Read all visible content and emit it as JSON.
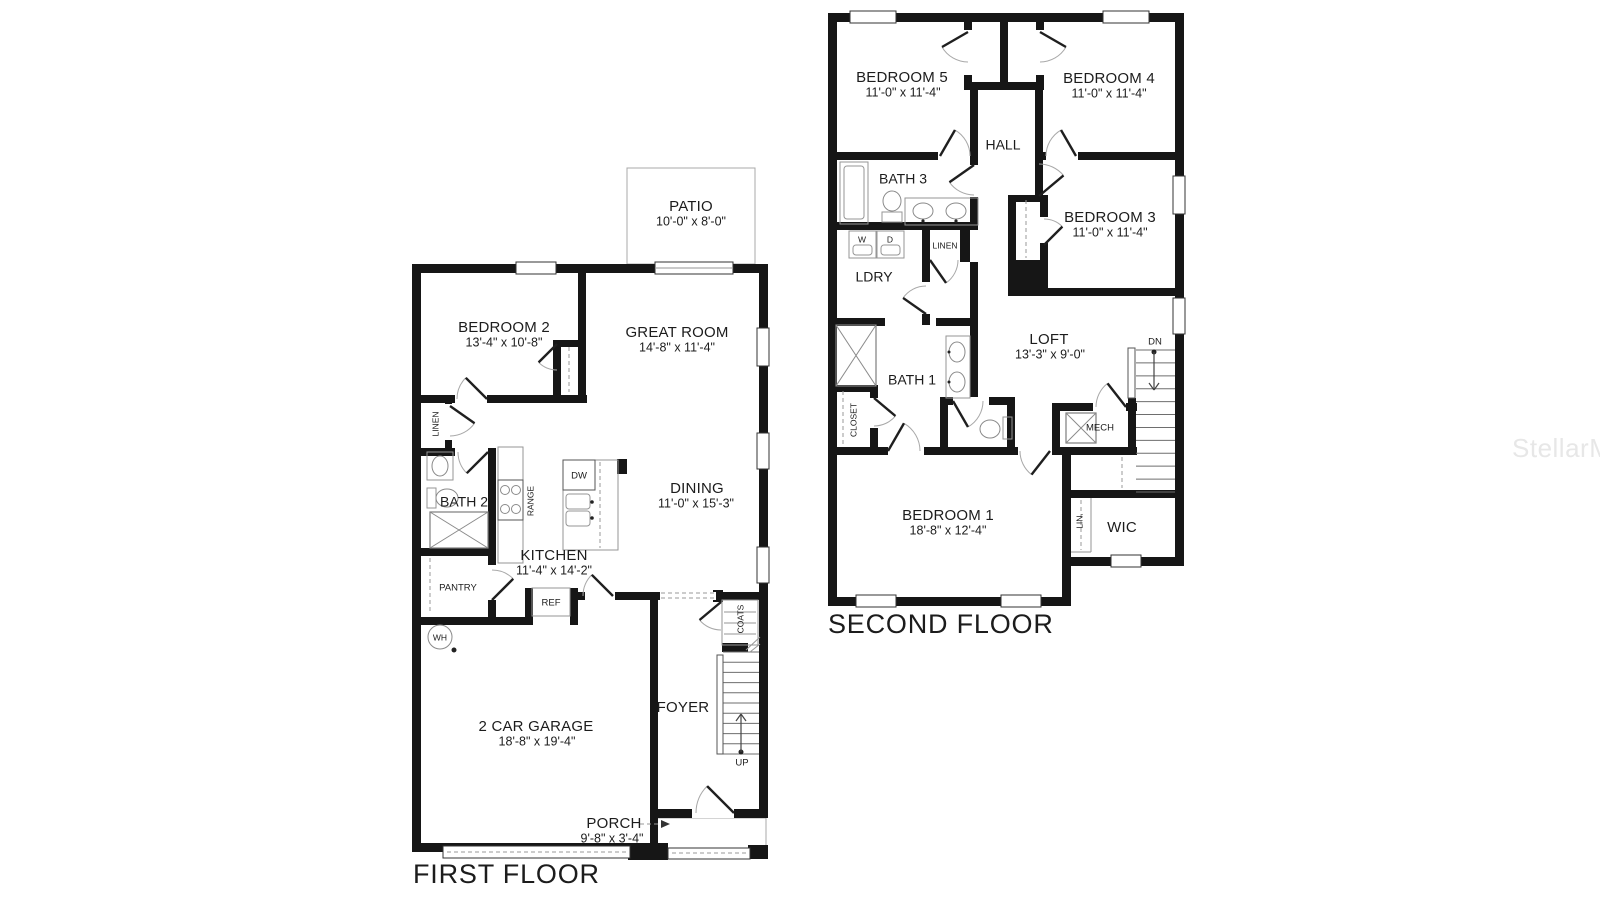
{
  "watermark": "StellarMLS",
  "ff": {
    "title": "FIRST FLOOR",
    "patio_label": "PATIO",
    "patio_dims": "10'-0\" x 8'-0\"",
    "bedroom2_label": "BEDROOM 2",
    "bedroom2_dims": "13'-4\" x 10'-8\"",
    "great_room_label": "GREAT ROOM",
    "great_room_dims": "14'-8\" x 11'-4\"",
    "dining_label": "DINING",
    "dining_dims": "11'-0\" x 15'-3\"",
    "kitchen_label": "KITCHEN",
    "kitchen_dims": "11'-4\" x 14'-2\"",
    "bath2_label": "BATH 2",
    "garage_label": "2 CAR GARAGE",
    "garage_dims": "18'-8\" x 19'-4\"",
    "foyer_label": "FOYER",
    "porch_label": "PORCH",
    "porch_dims": "9'-8\" x 3'-4\"",
    "linen_label": "LINEN",
    "pantry_label": "PANTRY",
    "range_label": "RANGE",
    "dw_label": "DW",
    "ref_label": "REF",
    "wh_label": "WH",
    "coats_label": "COATS",
    "up_label": "UP"
  },
  "sf": {
    "title": "SECOND FLOOR",
    "bedroom5_label": "BEDROOM 5",
    "bedroom5_dims": "11'-0\" x 11'-4\"",
    "bedroom4_label": "BEDROOM 4",
    "bedroom4_dims": "11'-0\" x 11'-4\"",
    "bedroom3_label": "BEDROOM 3",
    "bedroom3_dims": "11'-0\" x 11'-4\"",
    "bedroom1_label": "BEDROOM 1",
    "bedroom1_dims": "18'-8\" x 12'-4\"",
    "hall_label": "HALL",
    "bath3_label": "BATH 3",
    "bath1_label": "BATH 1",
    "ldry_label": "LDRY",
    "linen_label": "LINEN",
    "loft_label": "LOFT",
    "loft_dims": "13'-3\" x 9'-0\"",
    "closet_label": "CLOSET",
    "mech_label": "MECH",
    "wic_label": "WIC",
    "lin_label": "LIN.",
    "dn_label": "DN",
    "w_label": "W",
    "d_label": "D"
  }
}
